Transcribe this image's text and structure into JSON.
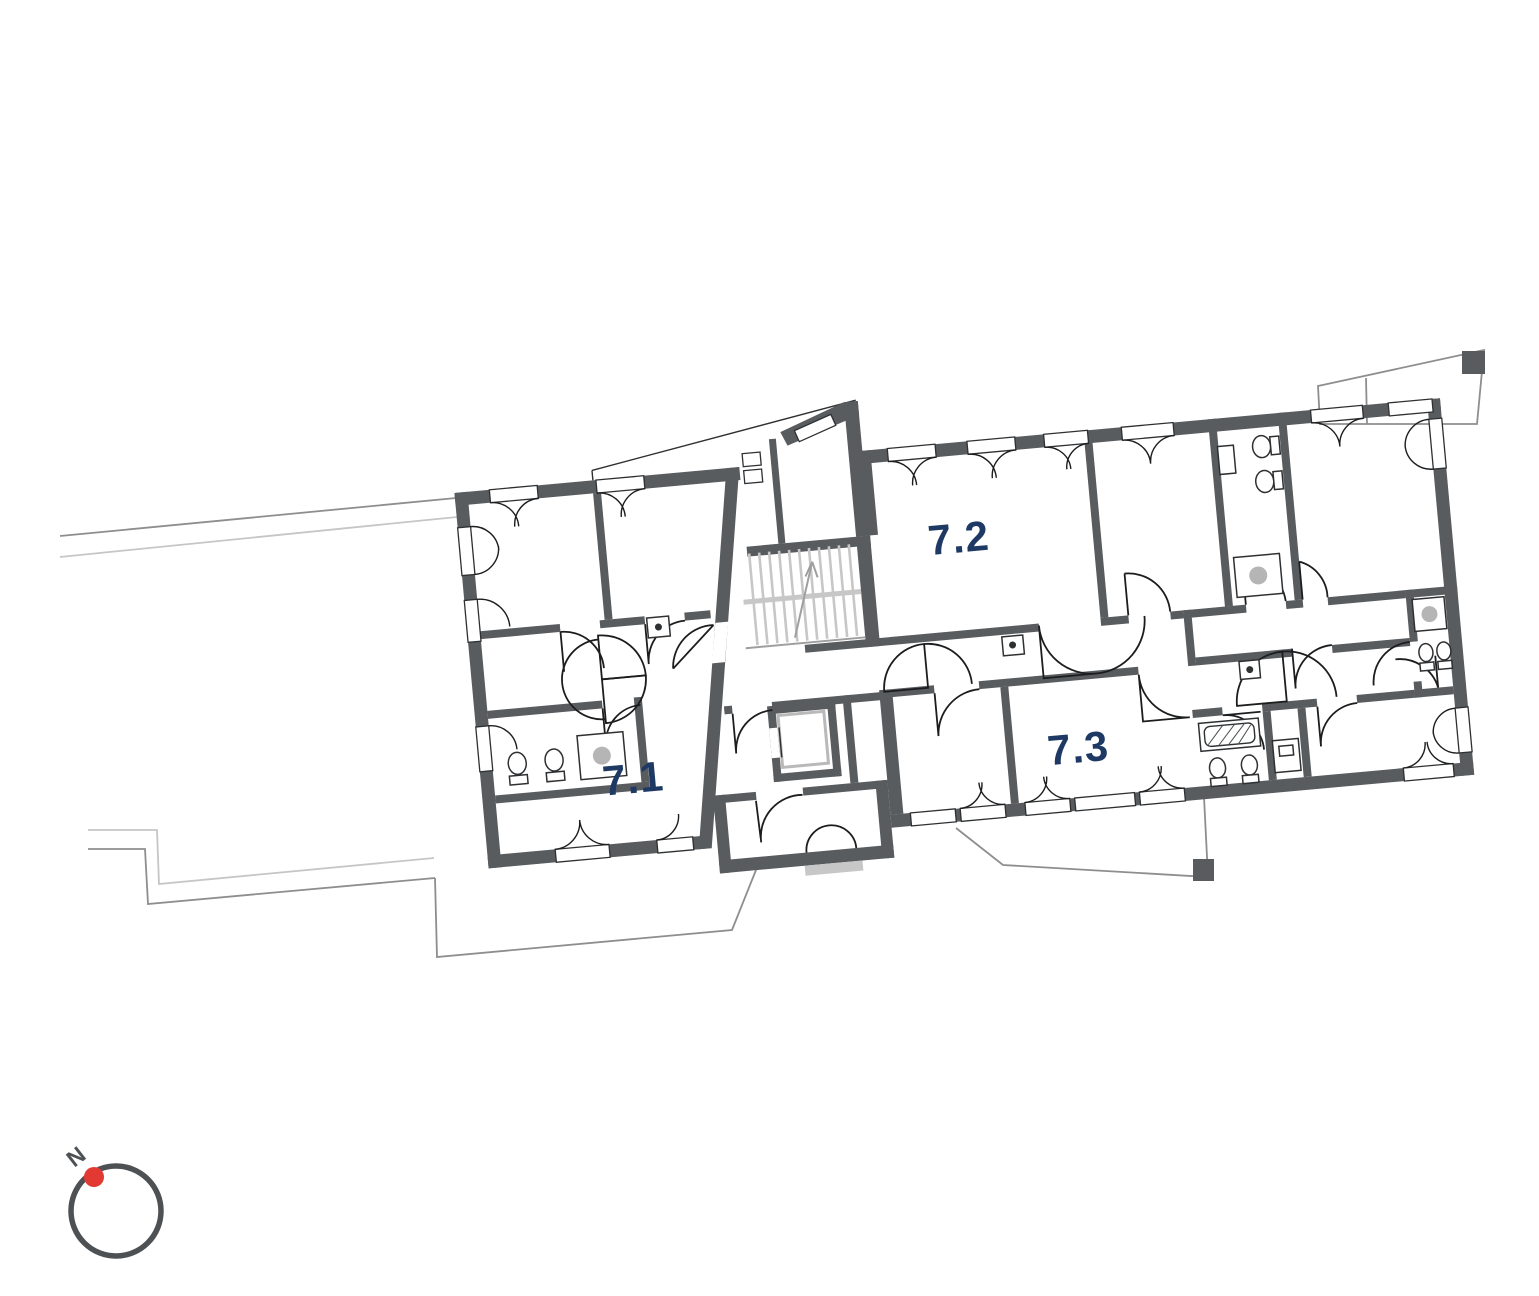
{
  "page": {
    "background_color": "#ffffff"
  },
  "floor_plan": {
    "type": "apartment-storey-plan",
    "units": [
      {
        "label": "7.1"
      },
      {
        "label": "7.2"
      },
      {
        "label": "7.3"
      }
    ],
    "unit_label_color": "#1e3a64",
    "wall_color": "#585c5f",
    "stair_color": "#c7c7c7",
    "fixture_dot_color": "#b5b5b5",
    "site_outline_color": "#8e8e8e"
  },
  "compass": {
    "north_label": "N",
    "ring_color": "#4d5154",
    "needle_dot_color": "#e23a32",
    "label_color": "#4d5154"
  }
}
